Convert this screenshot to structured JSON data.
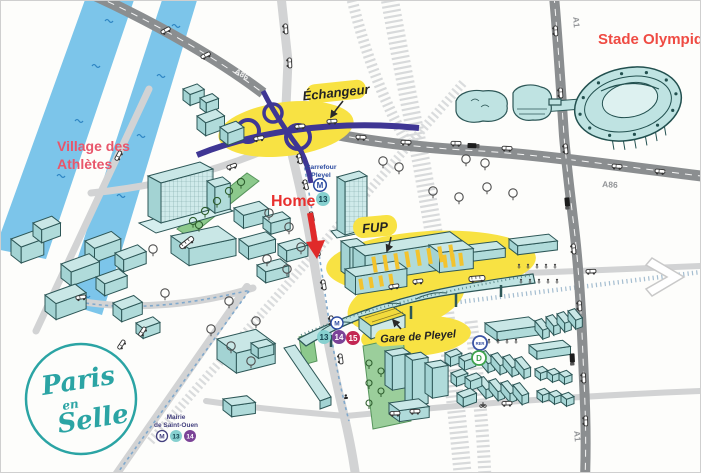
{
  "title": "Pleyel district illustrated map",
  "labels": {
    "stade_olympique": "Stade Olympique",
    "village_line1": "Village des",
    "village_line2": "Athlètes",
    "echangeur": "Échangeur",
    "home": "Home",
    "fup": "FUP",
    "gare_de_pleyel": "Gare de Pleyel",
    "carrefour_line1": "Carrefour",
    "carrefour_line2": "Pleyel",
    "mairie_line1": "Mairie",
    "mairie_line2": "de Saint-Ouen",
    "a86_north": "A86",
    "a86_east": "A86",
    "a1_north": "A1",
    "a1_south": "A1"
  },
  "badges": {
    "metro": "M",
    "line13": "13",
    "line14": "14",
    "line15": "15",
    "rer": "RER",
    "rer_d": "D"
  },
  "logo": {
    "word1": "Paris",
    "word2": "en",
    "word3": "Selle"
  },
  "colors": {
    "river": "#7cc5ea",
    "building_top": "#c9e7e6",
    "building_front": "#b0dbda",
    "building_side": "#a3d3d3",
    "building_stroke": "#2d5757",
    "highlight_yellow": "#f8e243",
    "interchange_purple": "#3f3694",
    "highway_gray": "#8b8e90",
    "road_gray": "#d2d3d4",
    "rail_gray": "#d8dadb",
    "green_space": "#8cc98c",
    "label_red": "#e8302e",
    "label_stade_red": "#ef4b43",
    "label_village_pink": "#e8566b",
    "label_blue": "#2b4aa0",
    "metro13": "#86d0cf",
    "metro14": "#7b4397",
    "metro15": "#c32753",
    "rer_blue": "#3b54a4",
    "rer_d_green": "#3da24b",
    "mairie_purple": "#43407e",
    "logo_teal": "#2ba4a4"
  }
}
